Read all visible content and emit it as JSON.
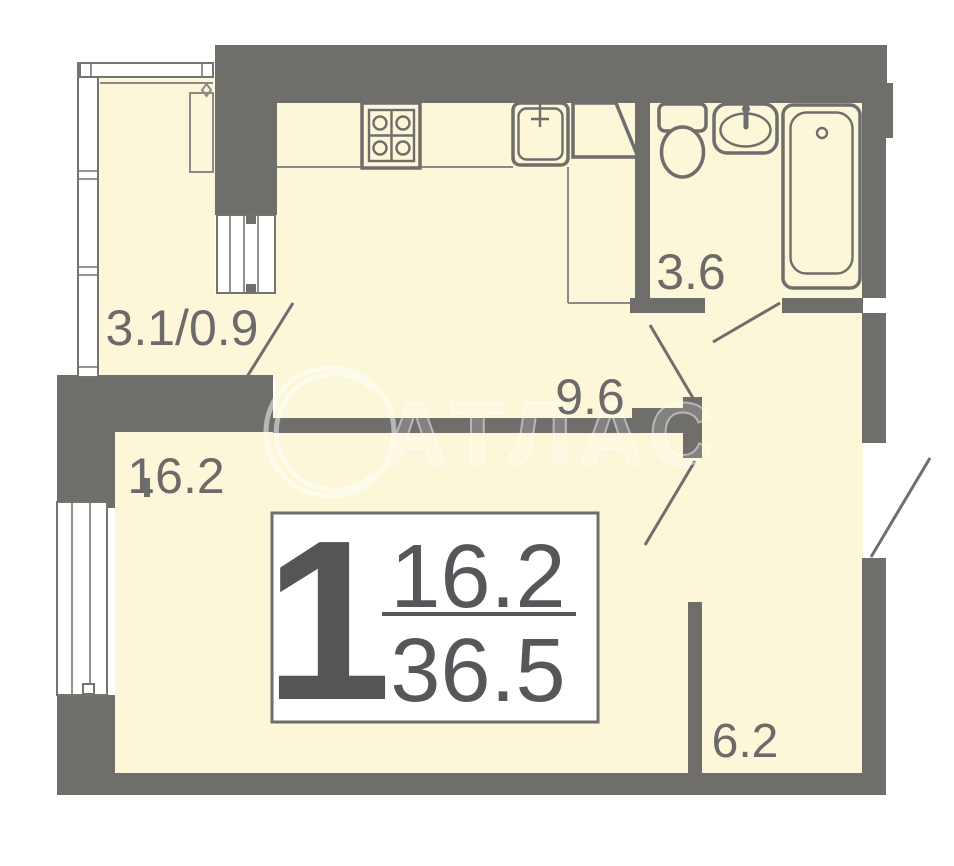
{
  "rooms": {
    "balcony": {
      "label": "3.1/0.9"
    },
    "kitchen": {
      "label": "9.6"
    },
    "bathroom": {
      "label": "3.6"
    },
    "living": {
      "label": "16.2"
    },
    "hall": {
      "label": "6.2"
    }
  },
  "info_box": {
    "room_count": "1",
    "living_area": "16.2",
    "total_area": "36.5"
  },
  "watermark": {
    "text": "АТЛАС"
  },
  "colors": {
    "wall": "#6F6E6B",
    "floor": "#FCF7D8",
    "label": "#6C6B69",
    "info_text": "#57565A",
    "window": "#FFFFFF",
    "thin_line": "#8B8A86",
    "watermark": "#FFFFFF"
  },
  "fixtures": [
    "stove-icon",
    "kitchen-sink-icon",
    "corner-cabinet-icon",
    "toilet-icon",
    "washbasin-icon",
    "bathtub-icon",
    "window-icon",
    "balcony-door-icon",
    "door-swing-icon"
  ]
}
